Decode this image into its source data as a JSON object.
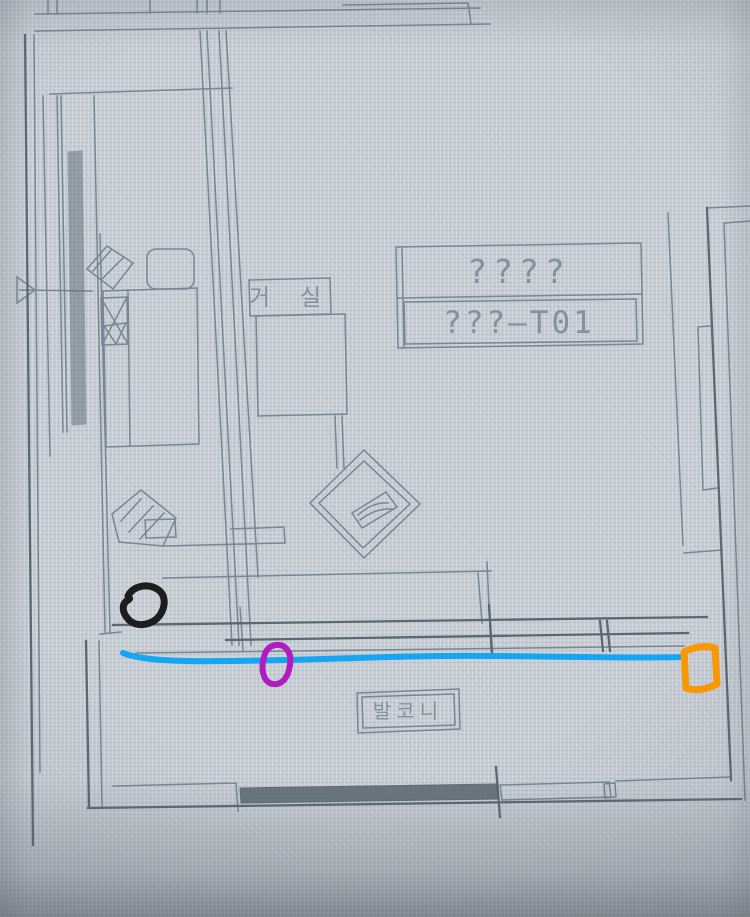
{
  "drawing": {
    "labels": {
      "living_room": "거 실",
      "balcony": "발코니"
    },
    "title_block": {
      "row1": "????",
      "row2": "???—T01"
    },
    "colors": {
      "line": "#72808d",
      "line_dark": "#57636d",
      "text": "#828e99",
      "background": "#c6cdd4"
    }
  },
  "annotations": {
    "black_loop": {
      "color": "#1d1d1f"
    },
    "blue_line": {
      "color": "#16a5f2"
    },
    "purple_oval": {
      "color": "#b01cc2"
    },
    "orange_box": {
      "color": "#fb9904"
    }
  }
}
